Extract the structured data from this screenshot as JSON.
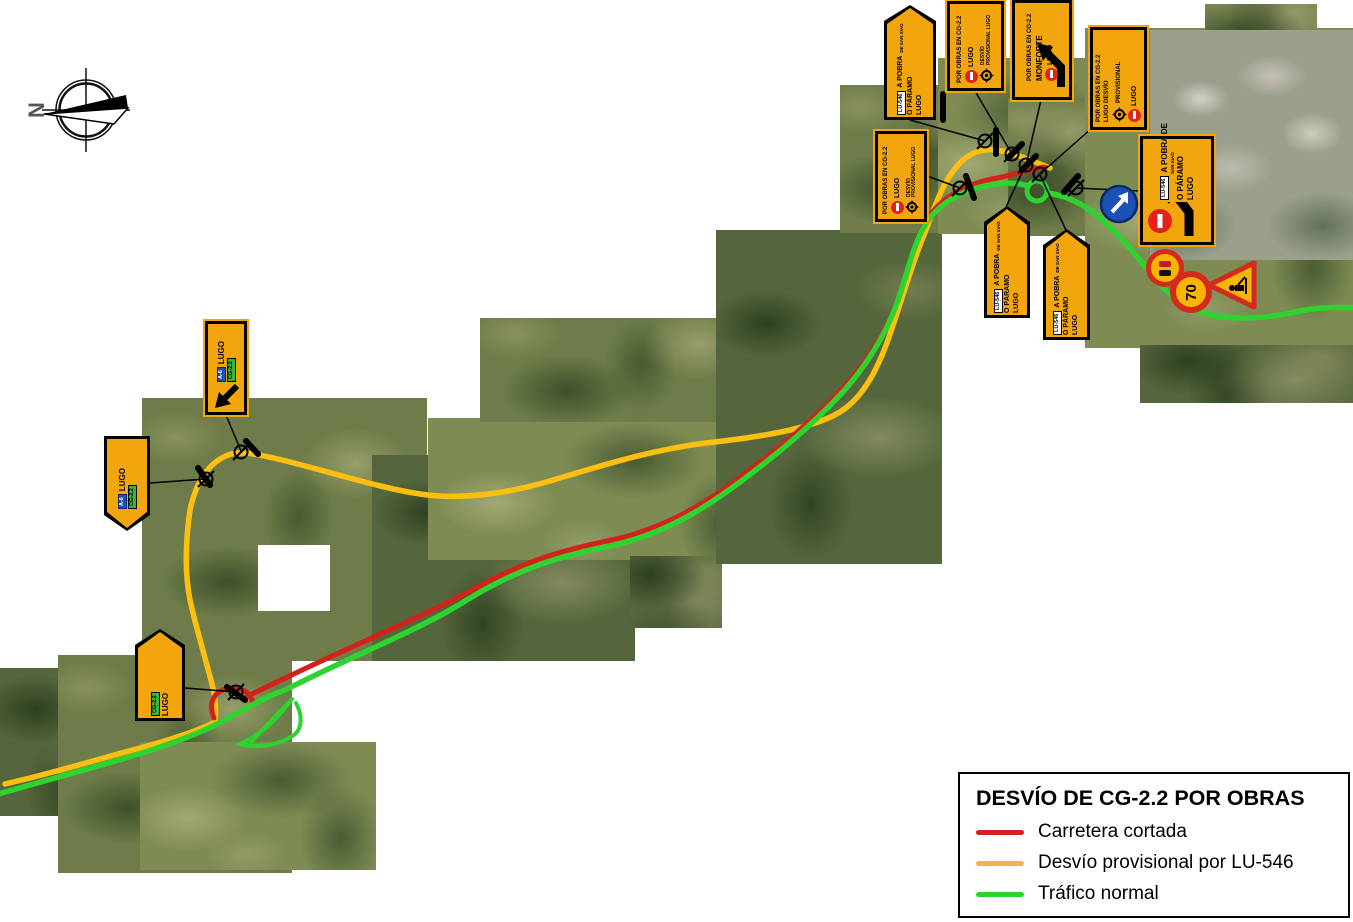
{
  "compass": {
    "north_label": "N"
  },
  "legend": {
    "title": "DESVÍO DE CG-2.2 POR OBRAS",
    "items": [
      {
        "label": "Carretera cortada",
        "color": "#c8281e"
      },
      {
        "label": "Desvío provisional por LU-546",
        "color": "#f2b43c"
      },
      {
        "label": "Tráfico normal",
        "color": "#2fd330"
      }
    ]
  },
  "signs": {
    "destination": {
      "chip": "LU-546",
      "line1": "A POBRA",
      "line1b": "DE SAN XIAO",
      "line2": "O PÁRAMO",
      "line3": "LUGO"
    },
    "big_destination": {
      "chip": "LU-546",
      "line1": "A POBRA DE",
      "line1b": "SAN XIAO",
      "line2": "O PÁRAMO",
      "line3": "LUGO"
    },
    "works_roundabout": {
      "line1": "POR OBRAS EN CG-2.2",
      "line2": "LUGO",
      "line3": "DESVÍO",
      "line4": "PROVISIONAL",
      "line5": "LUGO"
    },
    "works_monforte": {
      "line1": "POR OBRAS EN CG-2.2",
      "line2": "MONFORTE",
      "line3": "LUGO"
    },
    "works_lugo": {
      "line1": "POR OBRAS EN CG-2.2",
      "line2": "LUGO DESVÍO",
      "line3": "PROVISIONAL",
      "line4": "LUGO"
    },
    "exit_lugo": {
      "blue_chip": "A-6",
      "city": "LUGO",
      "green_chip": "CG-2.2"
    },
    "cg22": {
      "green_chip": "CG-2.2",
      "city": "LUGO"
    },
    "speed_limit": {
      "value": "70"
    }
  },
  "colors": {
    "route_closed": "#d2231a",
    "route_detour": "#fdc010",
    "route_normal": "#2fd330",
    "sign_panel": "#f2a50c"
  }
}
